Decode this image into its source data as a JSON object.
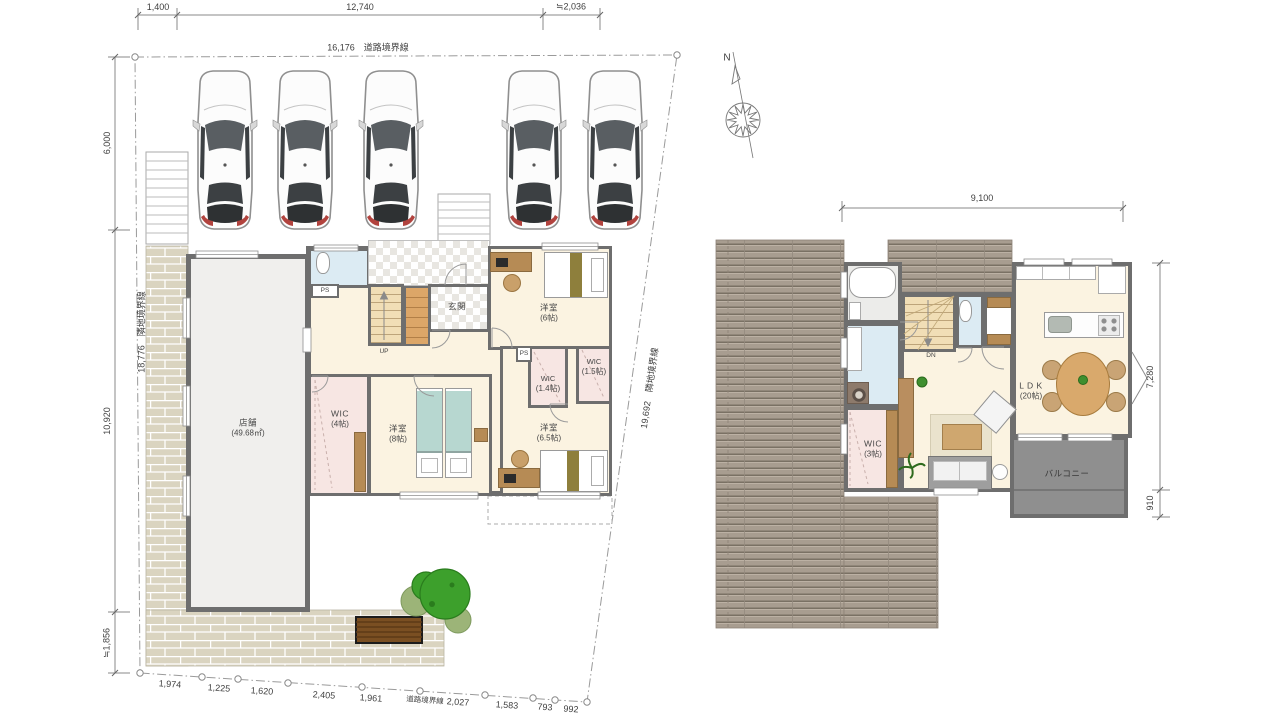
{
  "site": {
    "top_dims": {
      "d1": "1,400",
      "d2": "12,740",
      "d3": "≒2,036"
    },
    "top_boundary": "16,176　道路境界線",
    "left_dims": {
      "d1": "6,000",
      "d2": "10,920",
      "d3": "≒1,856"
    },
    "left_boundary": "18,776　隣地境界線",
    "right_boundary": "19,692　隣地境界線",
    "bottom_dims": {
      "d1": "1,974",
      "d2": "1,225",
      "d3": "1,620",
      "d4": "2,405",
      "d5": "1,961",
      "d6": "2,027",
      "d7": "1,583",
      "d8": "793",
      "d9": "992"
    },
    "bottom_boundary": "道路境界線"
  },
  "floor1": {
    "store": {
      "name": "店舗",
      "size": "(49.68㎡)"
    },
    "genkan": "玄関",
    "stairs_up": "UP",
    "ps1": "PS",
    "ps2": "PS",
    "bed6": {
      "name": "洋室",
      "size": "(6帖)"
    },
    "bed8": {
      "name": "洋室",
      "size": "(8帖)"
    },
    "bed65": {
      "name": "洋室",
      "size": "(6.5帖)"
    },
    "wic4": {
      "name": "WIC",
      "size": "(4帖)"
    },
    "wic14": {
      "name": "WIC",
      "size": "(1.4帖)"
    },
    "wic15": {
      "name": "WIC",
      "size": "(1.5帖)"
    }
  },
  "floor2": {
    "top_dim": "9,100",
    "right_dim_main": "7,280",
    "right_dim_balcony": "910",
    "ldk": {
      "name": "L D K",
      "size": "(20帖)"
    },
    "wic3": {
      "name": "WIC",
      "size": "(3帖)"
    },
    "balcony": "バルコニー",
    "stairs_dn": "DN"
  },
  "compass": {
    "north": "N"
  },
  "colors": {
    "wall": "#6e6e6e",
    "cream": "#fbf3e1",
    "pink": "#f7e6e3",
    "blue": "#dcebf3",
    "grayf": "#ececea",
    "stairs": "#f1deb6",
    "blanket": "#b7d7d0",
    "deck": "#a89d90",
    "balcony": "#8f8f8f",
    "brick": "#dad4c0",
    "tree": "#3da02c",
    "wood": "#dca668"
  }
}
